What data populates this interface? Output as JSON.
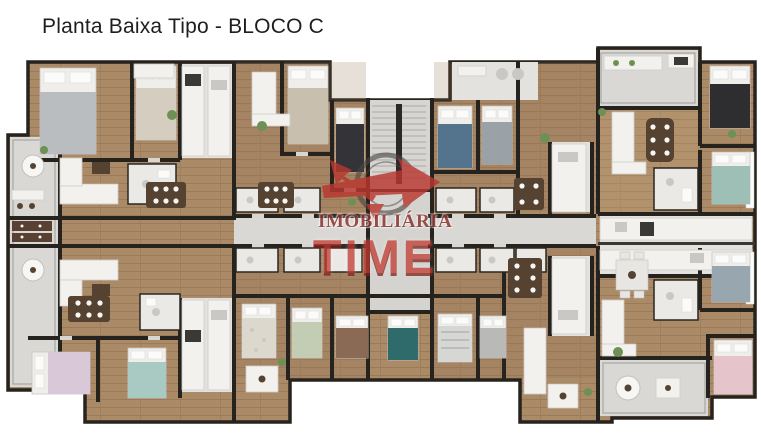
{
  "page": {
    "title": "Planta Baixa Tipo - BLOCO C",
    "background": "#ffffff"
  },
  "watermark": {
    "brand_top": "IMOBILIÁRIA",
    "brand_bottom": "TIME",
    "logo_icon": "compass-arrows-icon",
    "red": "#c23a31",
    "red_dark": "#7e221c",
    "maroon": "#8e3430"
  },
  "palette": {
    "bg": "#ffffff",
    "title": "#1e1e1e",
    "wall": "#26221d",
    "wood": "#ab8a67",
    "wood_dark": "#8f7050",
    "tile": "#d9d8d4",
    "bath": "#eae9e5",
    "red": "#c23a31",
    "red_dark": "#7e221c",
    "maroon": "#8e3430"
  }
}
